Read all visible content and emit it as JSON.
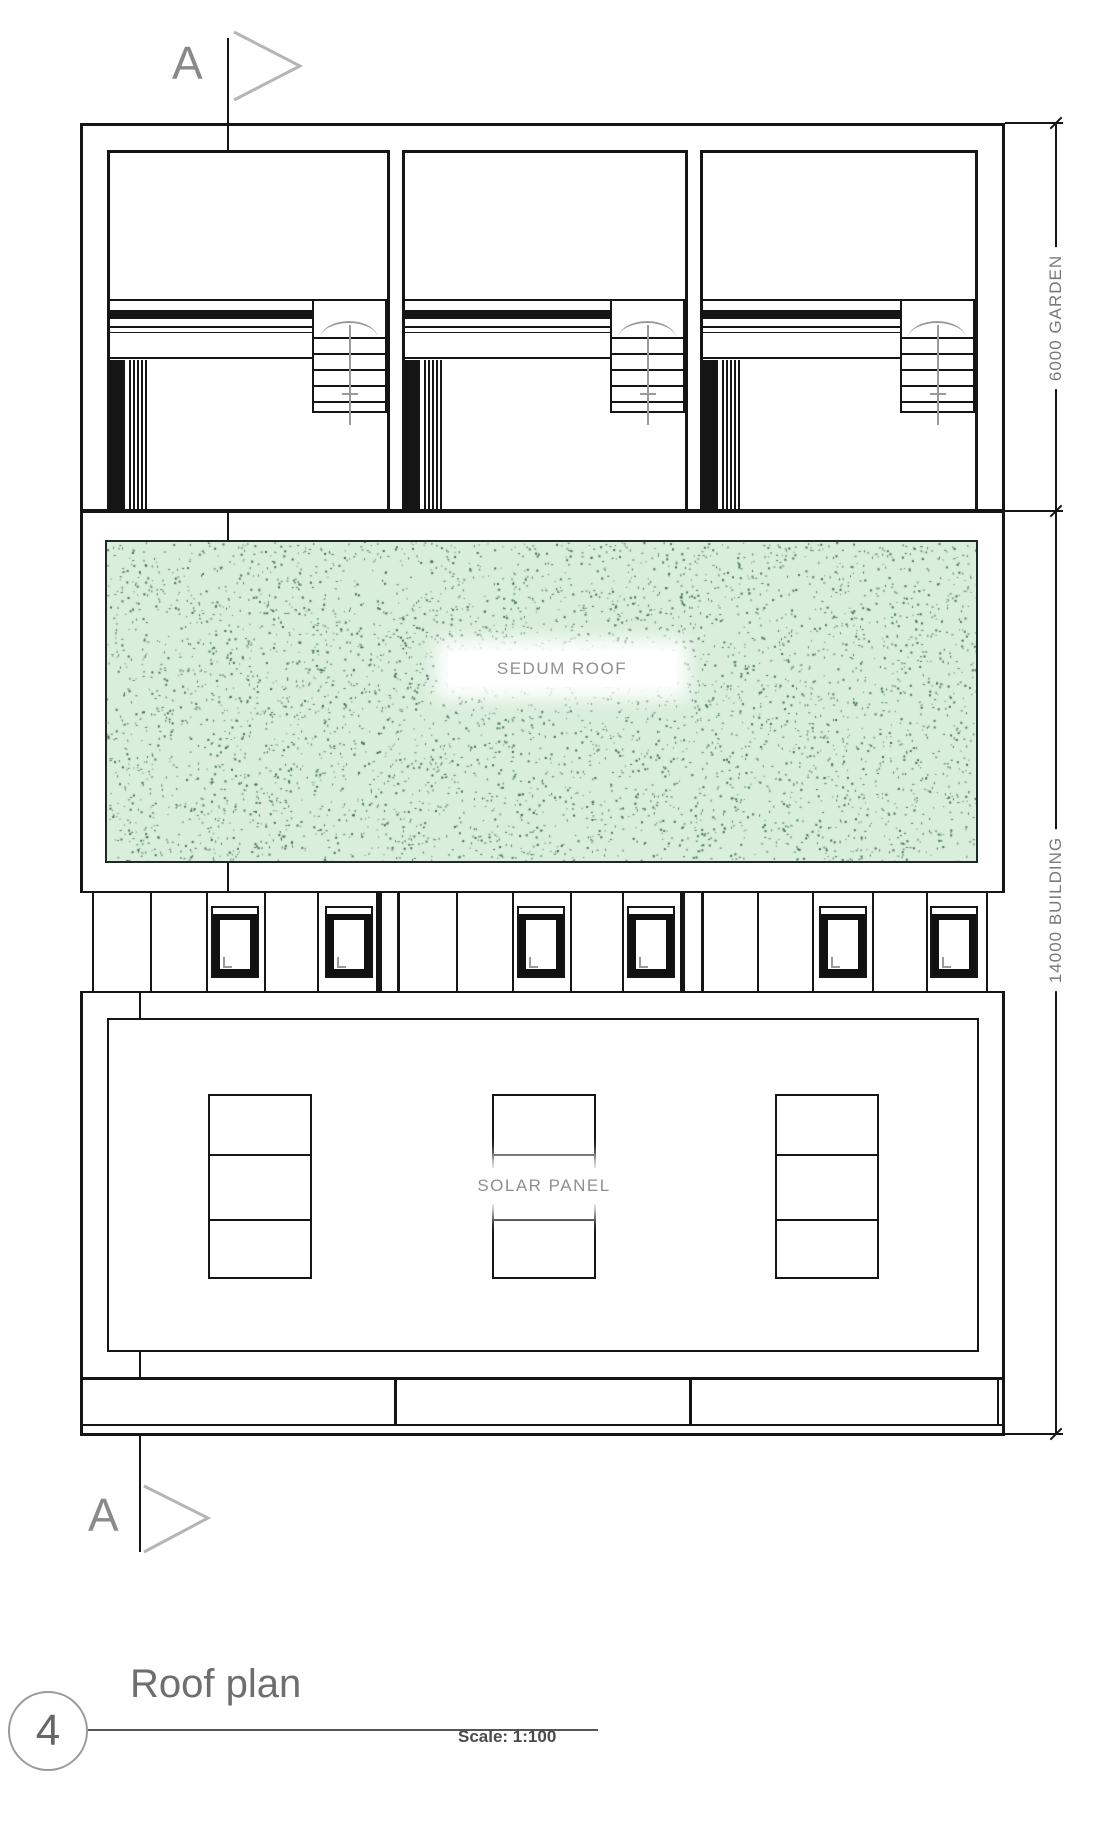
{
  "drawing": {
    "section_marker_label": "A",
    "sedum_label": "SEDUM ROOF",
    "solar_label": "SOLAR PANEL",
    "garden_dim_label": "6000 GARDEN",
    "building_dim_label": "14000 BUILDING"
  },
  "title_block": {
    "number": "4",
    "title": "Roof plan",
    "scale": "Scale: 1:100"
  },
  "colors": {
    "line": "#151515",
    "annotation_gray": "#8a8a8a",
    "sedum_fill": "#d9eedb",
    "sedum_dot_dark": "#3d6e54",
    "sedum_dot_light": "#4a7a5f"
  }
}
